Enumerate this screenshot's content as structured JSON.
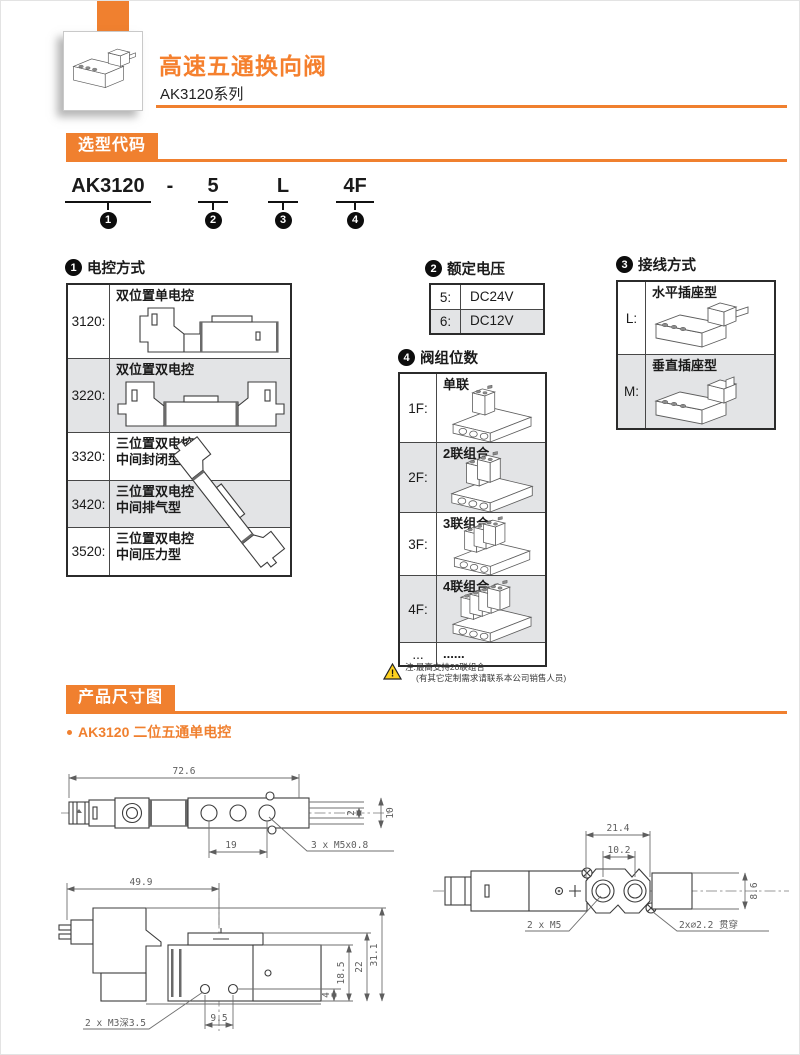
{
  "colors": {
    "accent": "#F0802F",
    "row_alt": "#E3E4E6",
    "warning_yellow": "#FFD21E",
    "title_orange": "#F5802E"
  },
  "header": {
    "title": "高速五通换向阀",
    "series": "AK3120系列"
  },
  "section_selection": {
    "title": "选型代码"
  },
  "model_code": {
    "separator": "-",
    "seg1": {
      "text": "AK3120",
      "digit": "1"
    },
    "seg2": {
      "text": "5",
      "digit": "2"
    },
    "seg3": {
      "text": "L",
      "digit": "3"
    },
    "seg4": {
      "text": "4F",
      "digit": "4"
    }
  },
  "control_table": {
    "digit": "1",
    "title": "电控方式",
    "rows": [
      {
        "code": "3120:",
        "desc1": "双位置单电控",
        "desc2": ""
      },
      {
        "code": "3220:",
        "desc1": "双位置双电控",
        "desc2": ""
      },
      {
        "code": "3320:",
        "desc1": "三位置双电控",
        "desc2": "中间封闭型"
      },
      {
        "code": "3420:",
        "desc1": "三位置双电控",
        "desc2": "中间排气型"
      },
      {
        "code": "3520:",
        "desc1": "三位置双电控",
        "desc2": "中间压力型"
      }
    ]
  },
  "voltage_table": {
    "digit": "2",
    "title": "额定电压",
    "rows": [
      {
        "code": "5:",
        "desc": "DC24V"
      },
      {
        "code": "6:",
        "desc": "DC12V"
      }
    ]
  },
  "wiring_table": {
    "digit": "3",
    "title": "接线方式",
    "rows": [
      {
        "code": "L:",
        "desc": "水平插座型"
      },
      {
        "code": "M:",
        "desc": "垂直插座型"
      }
    ]
  },
  "stations_table": {
    "digit": "4",
    "title": "阀组位数",
    "rows": [
      {
        "code": "1F:",
        "desc": "单联"
      },
      {
        "code": "2F:",
        "desc": "2联组合"
      },
      {
        "code": "3F:",
        "desc": "3联组合"
      },
      {
        "code": "4F:",
        "desc": "4联组合"
      },
      {
        "code": "...",
        "desc": "......"
      }
    ]
  },
  "note": {
    "line1": "注:最高支持20联组合",
    "line2": "(有其它定制需求请联系本公司销售人员)"
  },
  "section_dimensions": {
    "title": "产品尺寸图",
    "subtitle": "AK3120 二位五通单电控"
  },
  "drawings": {
    "top_view": {
      "overall_length": "72.6",
      "port_pitch": "19",
      "port_thread": "3 x M5x0.8",
      "body_width": "10",
      "slot_width": "2"
    },
    "side_view": {
      "length": "49.9",
      "overall_height": "31.1",
      "height_mid": "22",
      "height_port": "18.5",
      "hole_offset": "4",
      "hole_pitch": "9.5",
      "mount_thread": "2 x M3深3.5"
    },
    "bottom_view": {
      "flange_width": "21.4",
      "port_pitch": "10.2",
      "body_width": "8.6",
      "port_thread": "2 x M5",
      "through_hole": "2x∅2.2 贯穿"
    }
  }
}
